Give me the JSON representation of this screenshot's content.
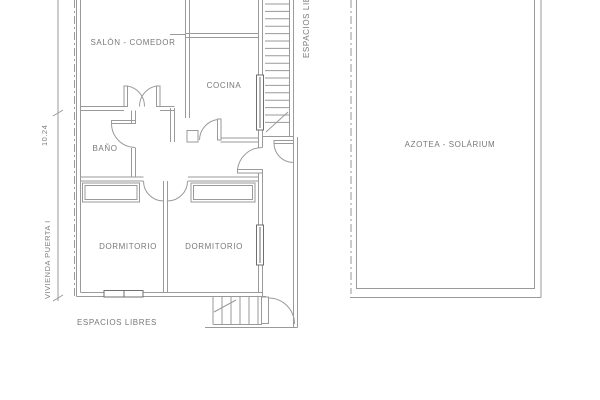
{
  "drawing": {
    "type": "architectural floor plan",
    "left_plan": {
      "name_vertical": "VIVIENDA PUERTA I",
      "dimension_value": "10.24",
      "rooms": {
        "salon": "SALÓN - COMEDOR",
        "cocina": "COCINA",
        "bano": "BAÑO",
        "dormitorio_1": "DORMITORIO",
        "dormitorio_2": "DORMITORIO"
      },
      "outdoor_label_bottom": "ESPACIOS LIBRES",
      "outdoor_label_right_vertical": "ESPACIOS LIBRES"
    },
    "right_plan": {
      "room": "AZOTEA - SOLÁRIUM"
    },
    "colors": {
      "background": "#ffffff",
      "line": "#9a9a9a",
      "line_dark": "#6f6f6f",
      "text": "#787878"
    }
  }
}
